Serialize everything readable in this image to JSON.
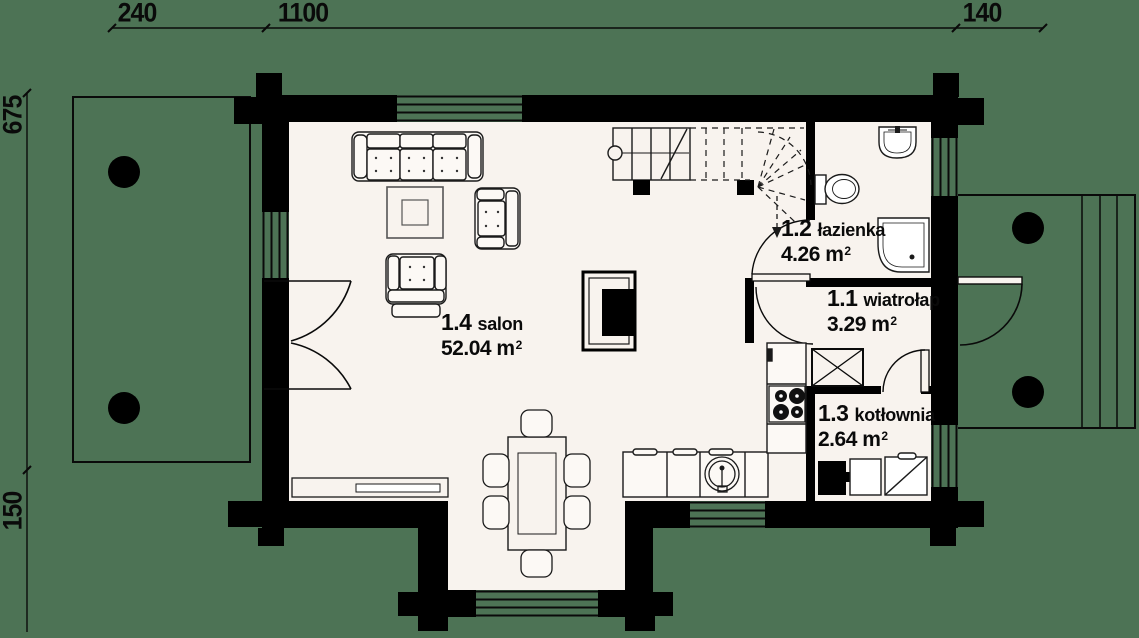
{
  "title": "Rzut parteru — plan domu",
  "colors": {
    "background": "#4D7355",
    "floor": "#F8F3EE",
    "wall": "#000000",
    "line": "#1A1A1A",
    "furniture_fill": "#FCF9F5"
  },
  "dimensions": {
    "top": [
      {
        "label": "240"
      },
      {
        "label": "1100"
      },
      {
        "label": "140"
      }
    ],
    "left": [
      {
        "label": "675"
      },
      {
        "label": "150"
      }
    ]
  },
  "rooms": [
    {
      "number": "1.4",
      "name": "salon",
      "area": "52.04"
    },
    {
      "number": "1.2",
      "name": "łazienka",
      "area": "4.26"
    },
    {
      "number": "1.1",
      "name": "wiatrołap",
      "area": "3.29"
    },
    {
      "number": "1.3",
      "name": "kotłownia",
      "area": "2.64"
    }
  ],
  "units": {
    "area": "m",
    "sup": "2"
  },
  "fixtures": [
    "sofa",
    "coffee-table",
    "armchair",
    "footstool",
    "fireplace",
    "dining-table",
    "dining-chair",
    "windowsill-bench",
    "kitchen-counter",
    "kitchen-sink",
    "cooktop",
    "fridge",
    "staircase",
    "down-arrow",
    "chimney-flue",
    "washbasin",
    "toilet",
    "shower",
    "boiler",
    "storage-cabinet",
    "water-heater",
    "terrace",
    "terrace-column",
    "porch",
    "porch-column",
    "porch-steps",
    "entrance-door",
    "terrace-french-doors",
    "bathroom-door",
    "vestibule-door",
    "boiler-room-door",
    "window"
  ]
}
